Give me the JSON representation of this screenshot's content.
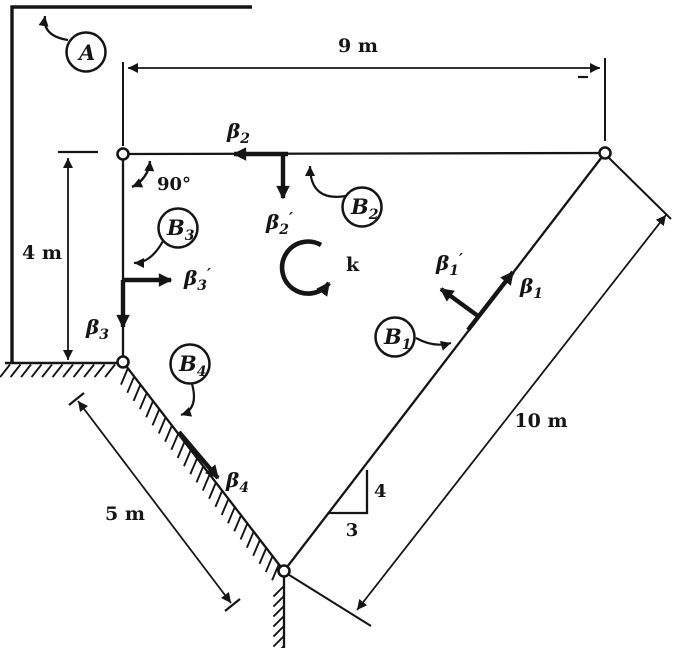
{
  "figure": {
    "kind": "statics link-support diagram",
    "ink_color": "#151515",
    "background_color": "#ffffff"
  },
  "callouts": {
    "a": {
      "label": "A"
    },
    "b1": {
      "label": "B",
      "sub": "1"
    },
    "b2": {
      "label": "B",
      "sub": "2"
    },
    "b3": {
      "label": "B",
      "sub": "3"
    },
    "b4": {
      "label": "B",
      "sub": "4"
    }
  },
  "vectors": {
    "beta1": {
      "symbol": "β",
      "sub": "1"
    },
    "beta1_prime": {
      "symbol": "β",
      "sub": "1",
      "prime": "′"
    },
    "beta2": {
      "symbol": "β",
      "sub": "2"
    },
    "beta2_prime": {
      "symbol": "β",
      "sub": "2",
      "prime": "′"
    },
    "beta3": {
      "symbol": "β",
      "sub": "3"
    },
    "beta3_prime": {
      "symbol": "β",
      "sub": "3",
      "prime": "′"
    },
    "beta4": {
      "symbol": "β",
      "sub": "4"
    },
    "k": {
      "symbol": "k"
    }
  },
  "dimensions": {
    "top_span": "9 m",
    "left_height": "4 m",
    "lower_left_link": "5 m",
    "lower_right_link": "10 m",
    "slope_rise": "4",
    "slope_run": "3",
    "corner_angle": "90°"
  }
}
